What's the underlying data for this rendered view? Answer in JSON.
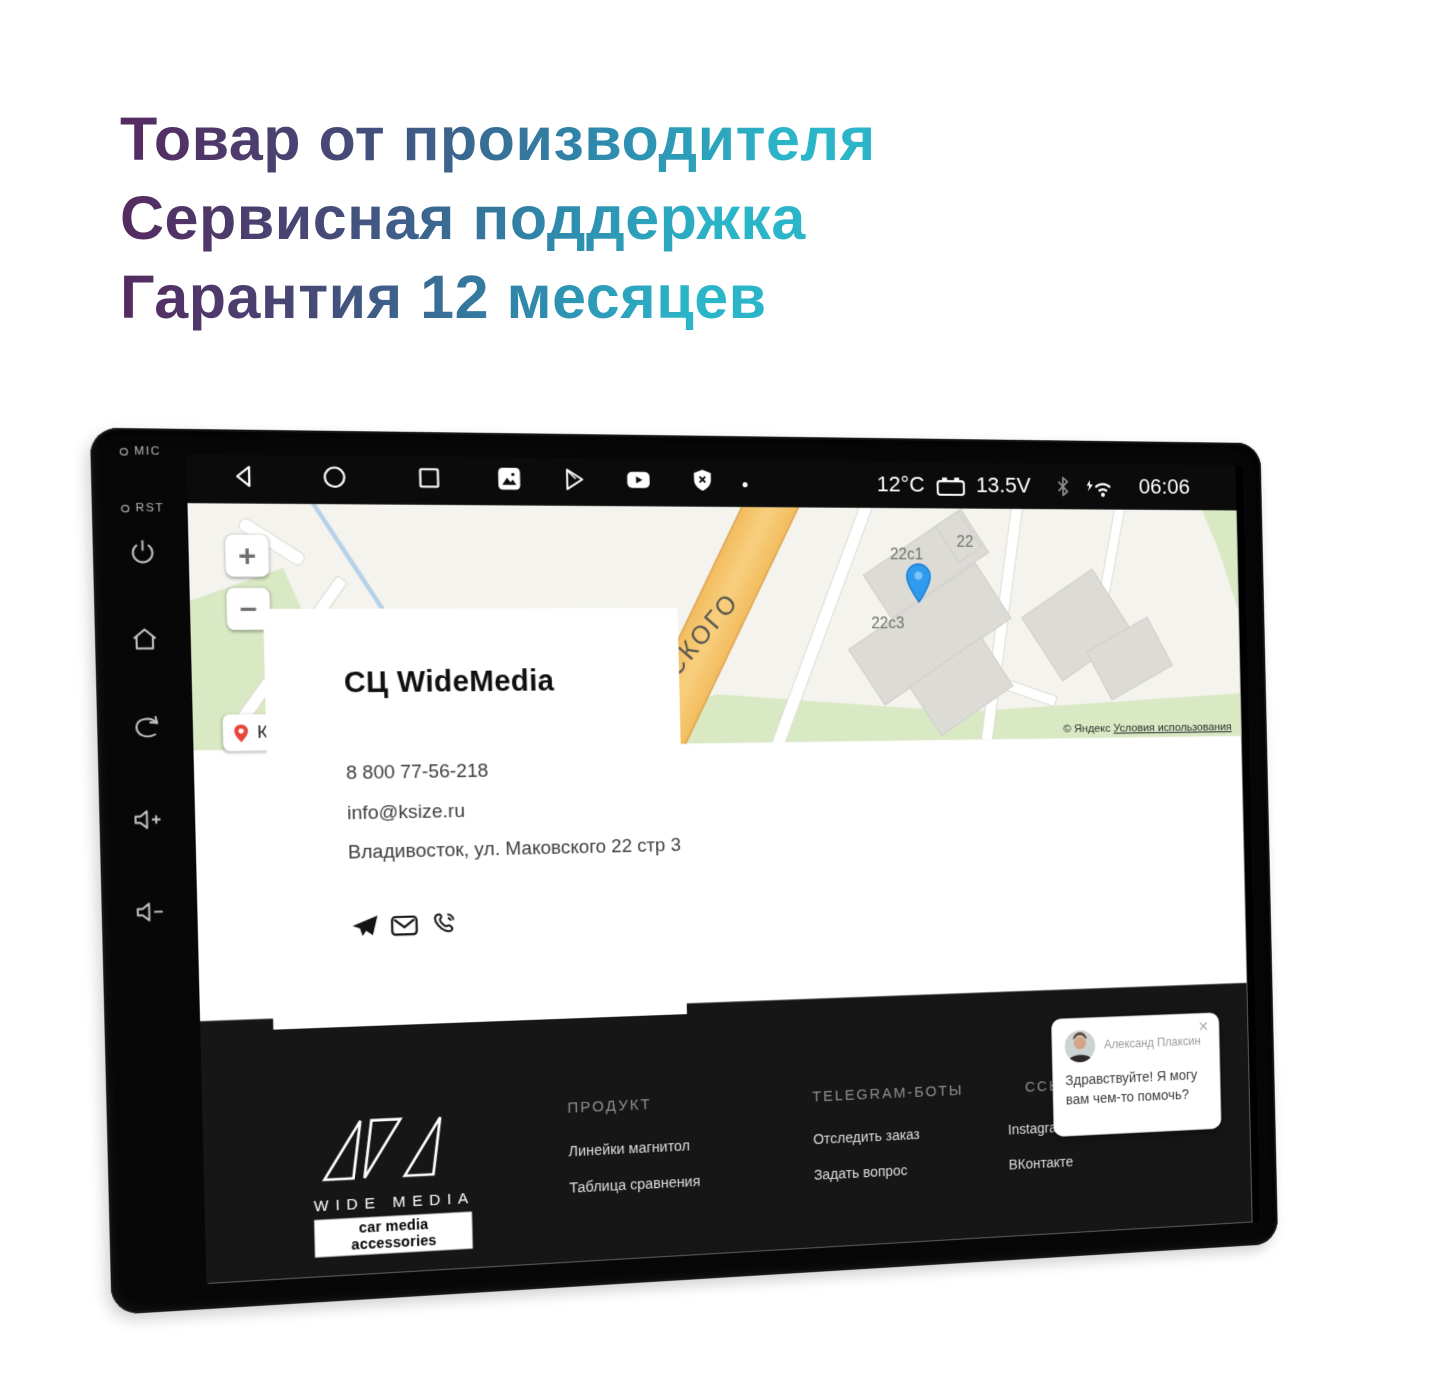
{
  "hero": {
    "lines": [
      "Товар от производителя",
      "Сервисная поддержка",
      "Гарантия 12 месяцев"
    ]
  },
  "device": {
    "bezel": {
      "mic_label": "MIC",
      "rst_label": "RST",
      "buttons": [
        "power",
        "home",
        "back",
        "volume-up",
        "volume-down"
      ]
    },
    "status_bar": {
      "left_icons": [
        "back",
        "home",
        "recents",
        "gallery",
        "play-store",
        "youtube",
        "shield-x",
        "dot"
      ],
      "right_icons": [
        "battery",
        "bluetooth",
        "wifi"
      ],
      "temperature": "12°C",
      "voltage": "13.5V",
      "time": "06:06"
    }
  },
  "page": {
    "map": {
      "street_label": "ОВСКОГО",
      "building_labels": [
        "22с1",
        "22",
        "22с3"
      ],
      "zoom_in": "+",
      "zoom_out": "−",
      "marker_label": "К",
      "attribution": "© Яндекс",
      "attribution_link": "Условия использования",
      "pin_color": "#2f9bee"
    },
    "contact": {
      "title": "СЦ WideMedia",
      "phone": "8 800 77-56-218",
      "email": "info@ksize.ru",
      "address": "Владивосток, ул. Маковского 22 стр 3",
      "icons": [
        "telegram",
        "email",
        "phone"
      ]
    },
    "footer": {
      "logo": {
        "brand": "WIDE MEDIA",
        "tagline": "car media accessories"
      },
      "columns": [
        {
          "heading": "ПРОДУКТ",
          "links": [
            "Линейки магнитол",
            "Таблица сравнения"
          ]
        },
        {
          "heading": "TELEGRAM-БОТЫ",
          "links": [
            "Отследить заказ",
            "Задать вопрос"
          ]
        },
        {
          "heading": "ССЫЛКИ",
          "links": [
            "Instagram",
            "ВКонтакте"
          ]
        }
      ]
    },
    "chat": {
      "name": "Александ Плаксин",
      "message": "Здравствуйте! Я могу вам чем-то помочь?",
      "close": "✕"
    }
  },
  "colors": {
    "accent_start": "#552a60",
    "accent_end": "#2bb5c8",
    "footer_bg": "#161616",
    "map_green": "#d9e9c4",
    "road_orange": "#f2bd5e"
  }
}
